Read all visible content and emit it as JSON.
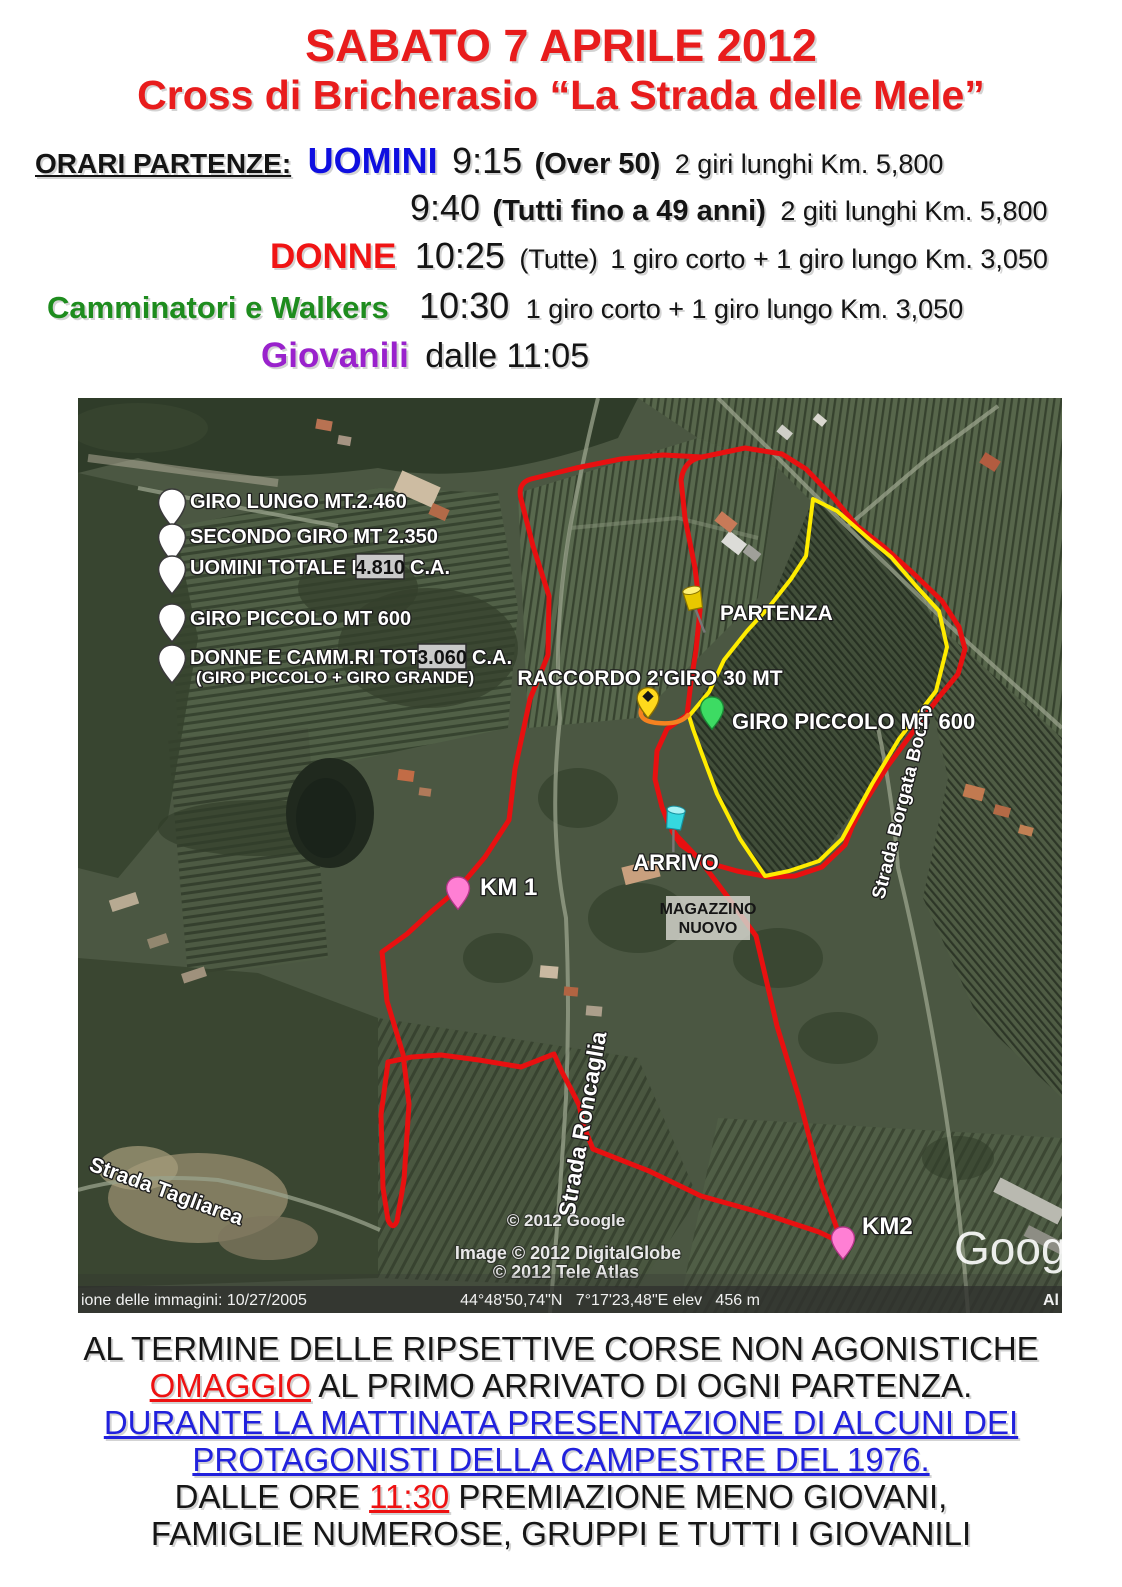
{
  "header": {
    "title": "SABATO 7 APRILE 2012",
    "subtitle": "Cross di Bricherasio “La Strada delle Mele”"
  },
  "schedule": {
    "heading": "ORARI PARTENZE:",
    "uomini_label": "UOMINI",
    "uomini_time1": "9:15",
    "uomini_detail1_bold": "(Over 50)",
    "uomini_detail1": "2 giri lunghi Km. 5,800",
    "uomini_time2": "9:40",
    "uomini_detail2_bold": "(Tutti fino a 49 anni)",
    "uomini_detail2": "2 giti lunghi Km. 5,800",
    "donne_label": "DONNE",
    "donne_time": "10:25",
    "donne_paren": "(Tutte)",
    "donne_detail": "1 giro corto + 1 giro lungo Km. 3,050",
    "camm_label": "Camminatori e Walkers",
    "camm_time": "10:30",
    "camm_detail": "1 giro corto + 1 giro lungo Km. 3,050",
    "giovanili_label": "Giovanili",
    "giovanili_time": "dalle 11:05"
  },
  "map": {
    "legend": [
      {
        "text": "GIRO LUNGO MT.2.460"
      },
      {
        "text": "SECONDO GIRO MT 2.350"
      },
      {
        "pre": "UOMINI TOTALE MT.",
        "value": "4.810",
        "post": "C.A."
      },
      {
        "text": "GIRO PICCOLO MT 600"
      },
      {
        "pre": "DONNE E CAMM.RI TOT. MT",
        "value": "3.060",
        "post": "C.A.",
        "sub": "(GIRO PICCOLO + GIRO GRANDE)"
      }
    ],
    "labels": {
      "partenza": "PARTENZA",
      "raccordo": "RACCORDO 2'GIRO 30 MT",
      "giro_piccolo": "GIRO PICCOLO MT 600",
      "arrivo": "ARRIVO",
      "magazzino1": "MAGAZZINO",
      "magazzino2": "NUOVO",
      "km1": "KM 1",
      "km2": "KM2"
    },
    "roads": {
      "tagliarea": "Strada Tagliarea",
      "roncaglia": "Strada Roncaglia",
      "borgata_bocco": "Strada Borgata Bocco"
    },
    "credits": {
      "google": "© 2012 Google",
      "digitalglobe": "Image © 2012 DigitalGlobe",
      "teleatlas": "© 2012 Tele Atlas",
      "watermark": "Google"
    },
    "statusbar": {
      "left": "ione delle immagini: 10/27/2005",
      "center": "44°48'50,74\"N   7°17'23,48\"E elev   456 m",
      "right": "Al"
    },
    "colors": {
      "route_long": "#e81010",
      "route_short": "#ffec00",
      "connector": "#f58220"
    }
  },
  "footer": {
    "line1": "AL TERMINE DELLE RIPSETTIVE CORSE NON AGONISTICHE",
    "line2_red": "OMAGGIO",
    "line2_rest": " AL PRIMO ARRIVATO DI OGNI PARTENZA.",
    "line3": "DURANTE LA MATTINATA PRESENTAZIONE DI ALCUNI DEI",
    "line4": "PROTAGONISTI DELLA CAMPESTRE DEL 1976.",
    "line5_pre": "DALLE ORE ",
    "line5_red": "11:30",
    "line5_post": " PREMIAZIONE MENO GIOVANI,",
    "line6": "FAMIGLIE NUMEROSE, GRUPPI E TUTTI I GIOVANILI"
  }
}
